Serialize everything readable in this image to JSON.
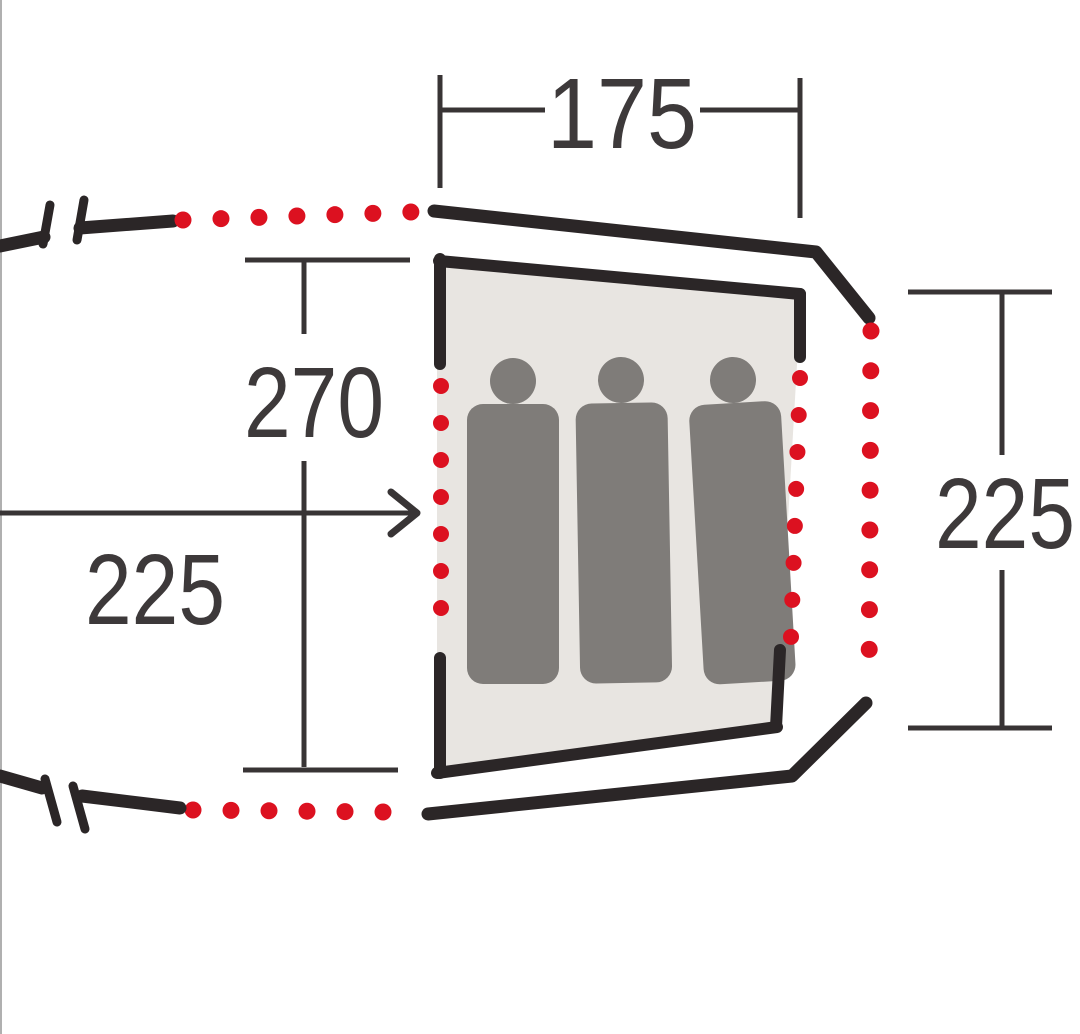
{
  "diagram": {
    "kind": "tent-floor-plan",
    "labels": {
      "top_width": "175",
      "cabin_depth": "270",
      "porch_length": "225",
      "cabin_width": "225"
    },
    "sleeping_figures_count": 3
  },
  "colors": {
    "background": "#ffffff",
    "outline": "#2b2627",
    "dimension": "#383435",
    "text_color": "#3d393a",
    "accent_red": "#dc1120",
    "cabin_fill": "#e8e5e1",
    "figure_gray": "#7f7c79"
  }
}
